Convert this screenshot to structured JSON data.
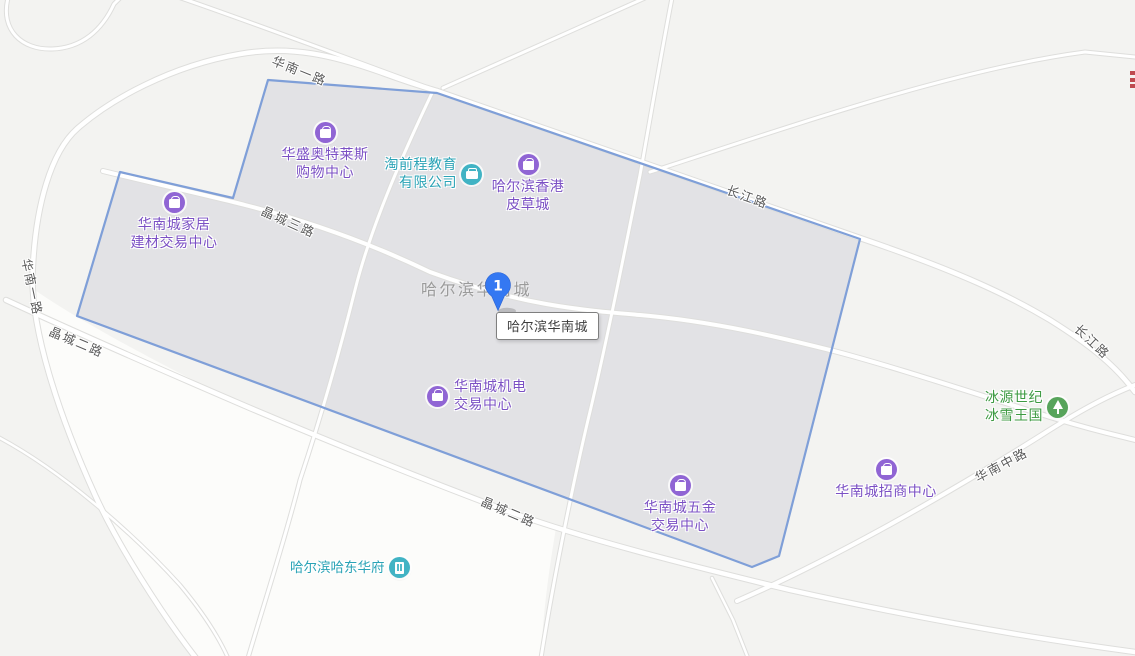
{
  "map": {
    "area_label": "哈尔滨华南城",
    "marker": {
      "number": "1",
      "color": "#3478f2"
    },
    "tooltip": {
      "text": "哈尔滨华南城"
    },
    "pois": [
      {
        "id": "huasheng-outlets",
        "label": "华盛奥特莱斯\n购物中心",
        "category": "shopping",
        "icon": "shopping-bag-icon",
        "color": "#7b50c4"
      },
      {
        "id": "taoqiancheng-education",
        "label": "淘前程教育\n有限公司",
        "category": "company",
        "icon": "briefcase-icon",
        "color": "#2aa3b6"
      },
      {
        "id": "harbin-hk-fur-city",
        "label": "哈尔滨香港\n皮草城",
        "category": "shopping",
        "icon": "shopping-bag-icon",
        "color": "#7b50c4"
      },
      {
        "id": "jiaju-jiancai-center",
        "label": "华南城家居\n建材交易中心",
        "category": "shopping",
        "icon": "shopping-bag-icon",
        "color": "#7b50c4"
      },
      {
        "id": "jidian-center",
        "label": "华南城机电\n交易中心",
        "category": "shopping",
        "icon": "shopping-bag-icon",
        "color": "#7b50c4"
      },
      {
        "id": "wujin-center",
        "label": "华南城五金\n交易中心",
        "category": "shopping",
        "icon": "shopping-bag-icon",
        "color": "#7b50c4"
      },
      {
        "id": "zhaoshang-center",
        "label": "华南城招商中心",
        "category": "shopping",
        "icon": "shopping-bag-icon",
        "color": "#7b50c4"
      },
      {
        "id": "bingxue-kingdom",
        "label": "冰源世纪\n冰雪王国",
        "category": "attraction",
        "icon": "attraction-icon",
        "color": "#3d9a42"
      },
      {
        "id": "hadong-huafu",
        "label": "哈尔滨哈东华府",
        "category": "residence",
        "icon": "building-icon",
        "color": "#2aa3b6"
      }
    ],
    "road_labels": [
      {
        "id": "huanan-1st-rd-top",
        "text": "华南一路"
      },
      {
        "id": "huanan-1st-rd-left",
        "text": "华南一路"
      },
      {
        "id": "jingcheng-3rd-rd",
        "text": "晶城三路"
      },
      {
        "id": "jingcheng-2nd-rd-left",
        "text": "晶城二路"
      },
      {
        "id": "jingcheng-2nd-rd-btm",
        "text": "晶城二路"
      },
      {
        "id": "changjiang-rd-top",
        "text": "长江路"
      },
      {
        "id": "changjiang-rd-right",
        "text": "长江路"
      },
      {
        "id": "huanan-mid-rd",
        "text": "华南中路"
      }
    ],
    "colors": {
      "background": "#f3f3f1",
      "district_fill": "#fcfcfa",
      "selection_fill": "#e2e2e5",
      "selection_border": "#7f9fd8",
      "road_fill": "#ffffff",
      "road_casing": "#dededc",
      "poi_purple": "#7b50c4",
      "poi_teal": "#2aa3b6",
      "poi_green": "#3d9a42",
      "road_label_text": "#595959",
      "area_label_text": "#9b9b9b",
      "marker_blue": "#3478f2",
      "clipped_label_red": "#bf4a50"
    }
  }
}
